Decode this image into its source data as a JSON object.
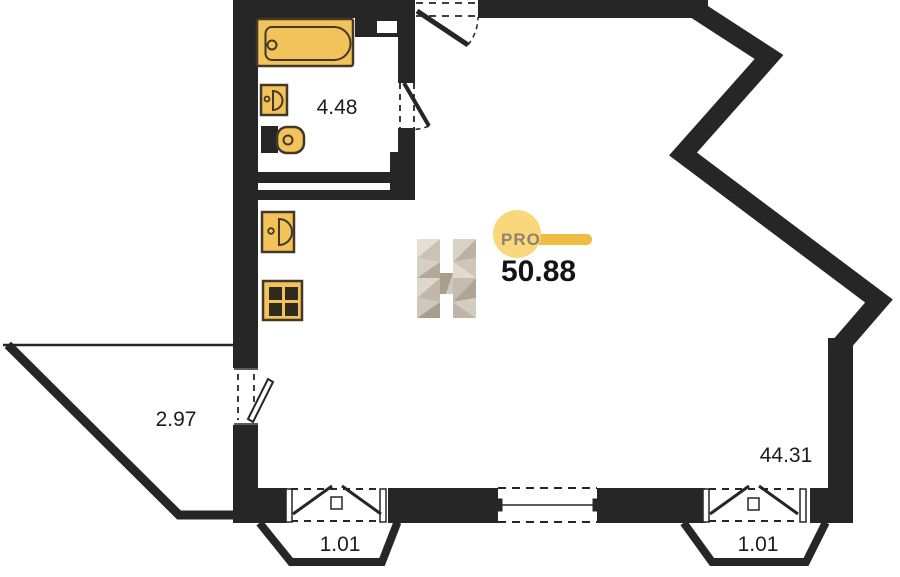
{
  "plan": {
    "title": "apartment-floor-plan",
    "total_area": "50.88",
    "brand": {
      "pro_label": "PRO"
    },
    "rooms": {
      "bathroom": {
        "area": "4.48"
      },
      "balcony": {
        "area": "2.97"
      },
      "living": {
        "area": "44.31"
      },
      "bay_left": {
        "area": "1.01"
      },
      "bay_right": {
        "area": "1.01"
      }
    },
    "fixtures": {
      "bathtub": "bathtub-icon",
      "washbasin": "washbasin-icon",
      "toilet": "toilet-icon",
      "kitchen_sink": "kitchen-sink-icon",
      "stove": "stove-icon"
    },
    "colors": {
      "wall": "#262626",
      "fixture_fill": "#f3c35b",
      "fixture_stroke": "#42382a",
      "burner": "#2f2a1e",
      "accent_circle": "#f9d87c",
      "accent_bar": "#f0bc43",
      "pro_text": "#8e8372",
      "label_text": "#1c1c1c",
      "total_text": "#141414"
    }
  }
}
